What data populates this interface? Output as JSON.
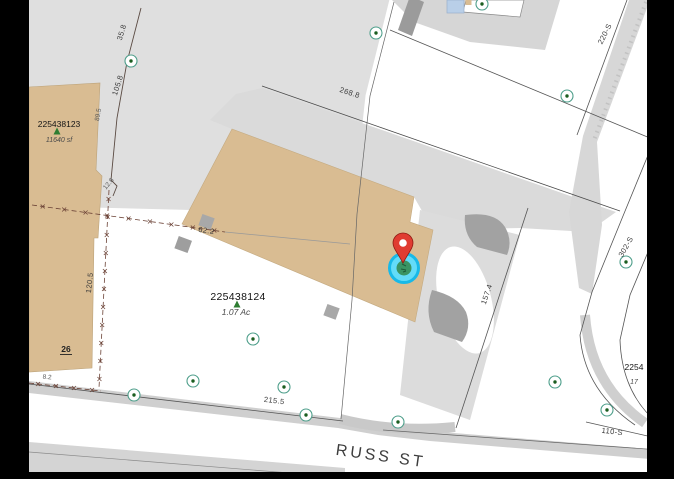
{
  "map": {
    "street_label": "RUSS ST",
    "parcels": [
      {
        "id": "225438123",
        "area": "11640 sf"
      },
      {
        "id": "225438124",
        "area": "1.07 Ac"
      },
      {
        "id": "2254",
        "area": "17"
      }
    ],
    "building_number": "26",
    "dimension_labels": [
      "62.2",
      "35.8",
      "105.8",
      "89.5",
      "12.8",
      "120.5",
      "268.8",
      "215.5",
      "157.4",
      "220-S",
      "302-S",
      "110-S",
      "8.2"
    ],
    "labels": [
      {
        "text": "62.2",
        "x": 206,
        "y": 233,
        "rot": 9,
        "cls": "dim"
      },
      {
        "text": "35.8",
        "x": 124,
        "y": 33,
        "rot": -73,
        "cls": "dim"
      },
      {
        "text": "105.8",
        "x": 120,
        "y": 86,
        "rot": -72,
        "cls": "dim"
      },
      {
        "text": "89.5",
        "x": 100,
        "y": 115,
        "rot": -80,
        "cls": "dim-small"
      },
      {
        "text": "12.8",
        "x": 110,
        "y": 185,
        "rot": -50,
        "cls": "dim-small"
      },
      {
        "text": "120.5",
        "x": 92,
        "y": 283,
        "rot": -84,
        "cls": "dim"
      },
      {
        "text": "268.8",
        "x": 349,
        "y": 95,
        "rot": 18,
        "cls": "dim"
      },
      {
        "text": "215.5",
        "x": 274,
        "y": 403,
        "rot": 7,
        "cls": "dim"
      },
      {
        "text": "157.4",
        "x": 489,
        "y": 295,
        "rot": -71,
        "cls": "dim"
      },
      {
        "text": "220-S",
        "x": 607,
        "y": 35,
        "rot": -63,
        "cls": "dim"
      },
      {
        "text": "302-S",
        "x": 628,
        "y": 248,
        "rot": -60,
        "cls": "dim"
      },
      {
        "text": "110-S",
        "x": 612,
        "y": 434,
        "rot": 7,
        "cls": "dim"
      },
      {
        "text": "8.2",
        "x": 47,
        "y": 379,
        "rot": 4,
        "cls": "dim-small"
      },
      {
        "text": "26",
        "x": 66,
        "y": 352,
        "rot": 0,
        "cls": "bldg",
        "underline": true
      },
      {
        "text": "225438123",
        "x": 59,
        "y": 127,
        "rot": 0,
        "cls": "parcel-id"
      },
      {
        "text": "11640 sf",
        "x": 59,
        "y": 142,
        "rot": 0,
        "cls": "parcel-area"
      },
      {
        "text": "225438124",
        "x": 238,
        "y": 300,
        "rot": 0,
        "cls": "parcel-id-lg"
      },
      {
        "text": "1.07 Ac",
        "x": 236,
        "y": 315,
        "rot": 0,
        "cls": "parcel-area-lg"
      },
      {
        "text": "2254",
        "x": 634,
        "y": 370,
        "rot": 0,
        "cls": "parcel-id"
      },
      {
        "text": "17",
        "x": 634,
        "y": 384,
        "rot": 0,
        "cls": "parcel-area"
      },
      {
        "text": "RUSS ST",
        "x": 380,
        "y": 461,
        "rot": 8,
        "cls": "street"
      }
    ],
    "survey_points": [
      [
        131,
        61
      ],
      [
        376,
        33
      ],
      [
        482,
        4
      ],
      [
        567,
        96
      ],
      [
        626,
        262
      ],
      [
        134,
        395
      ],
      [
        193,
        381
      ],
      [
        253,
        339
      ],
      [
        284,
        387
      ],
      [
        306,
        415
      ],
      [
        398,
        422
      ],
      [
        555,
        382
      ],
      [
        607,
        410
      ]
    ],
    "tree_symbols": [
      [
        57,
        132
      ],
      [
        237,
        305
      ]
    ],
    "fences": [
      {
        "x1": 32,
        "y1": 205,
        "x2": 225,
        "y2": 232,
        "marks": 9
      },
      {
        "x1": 109,
        "y1": 190,
        "x2": 99,
        "y2": 388,
        "marks": 11
      },
      {
        "x1": 29,
        "y1": 383,
        "x2": 101,
        "y2": 391,
        "marks": 4
      }
    ],
    "pin": {
      "x": 403,
      "y": 268
    },
    "colors": {
      "building_tan": "#d9bc92",
      "paving_light": "#dfdfdf",
      "paving_mid": "#d6d6d6",
      "structure_gray": "#9e9e9e",
      "boundary": "#555555",
      "fence": "#6b4236",
      "survey_ring": "#4d9e8a",
      "survey_dot": "#1b5e20",
      "tree_green": "#2e7d32",
      "pin_red": "#e03c31",
      "highlight_cyan": "#45d6f7",
      "highlight_ring": "#18b9e8"
    }
  }
}
